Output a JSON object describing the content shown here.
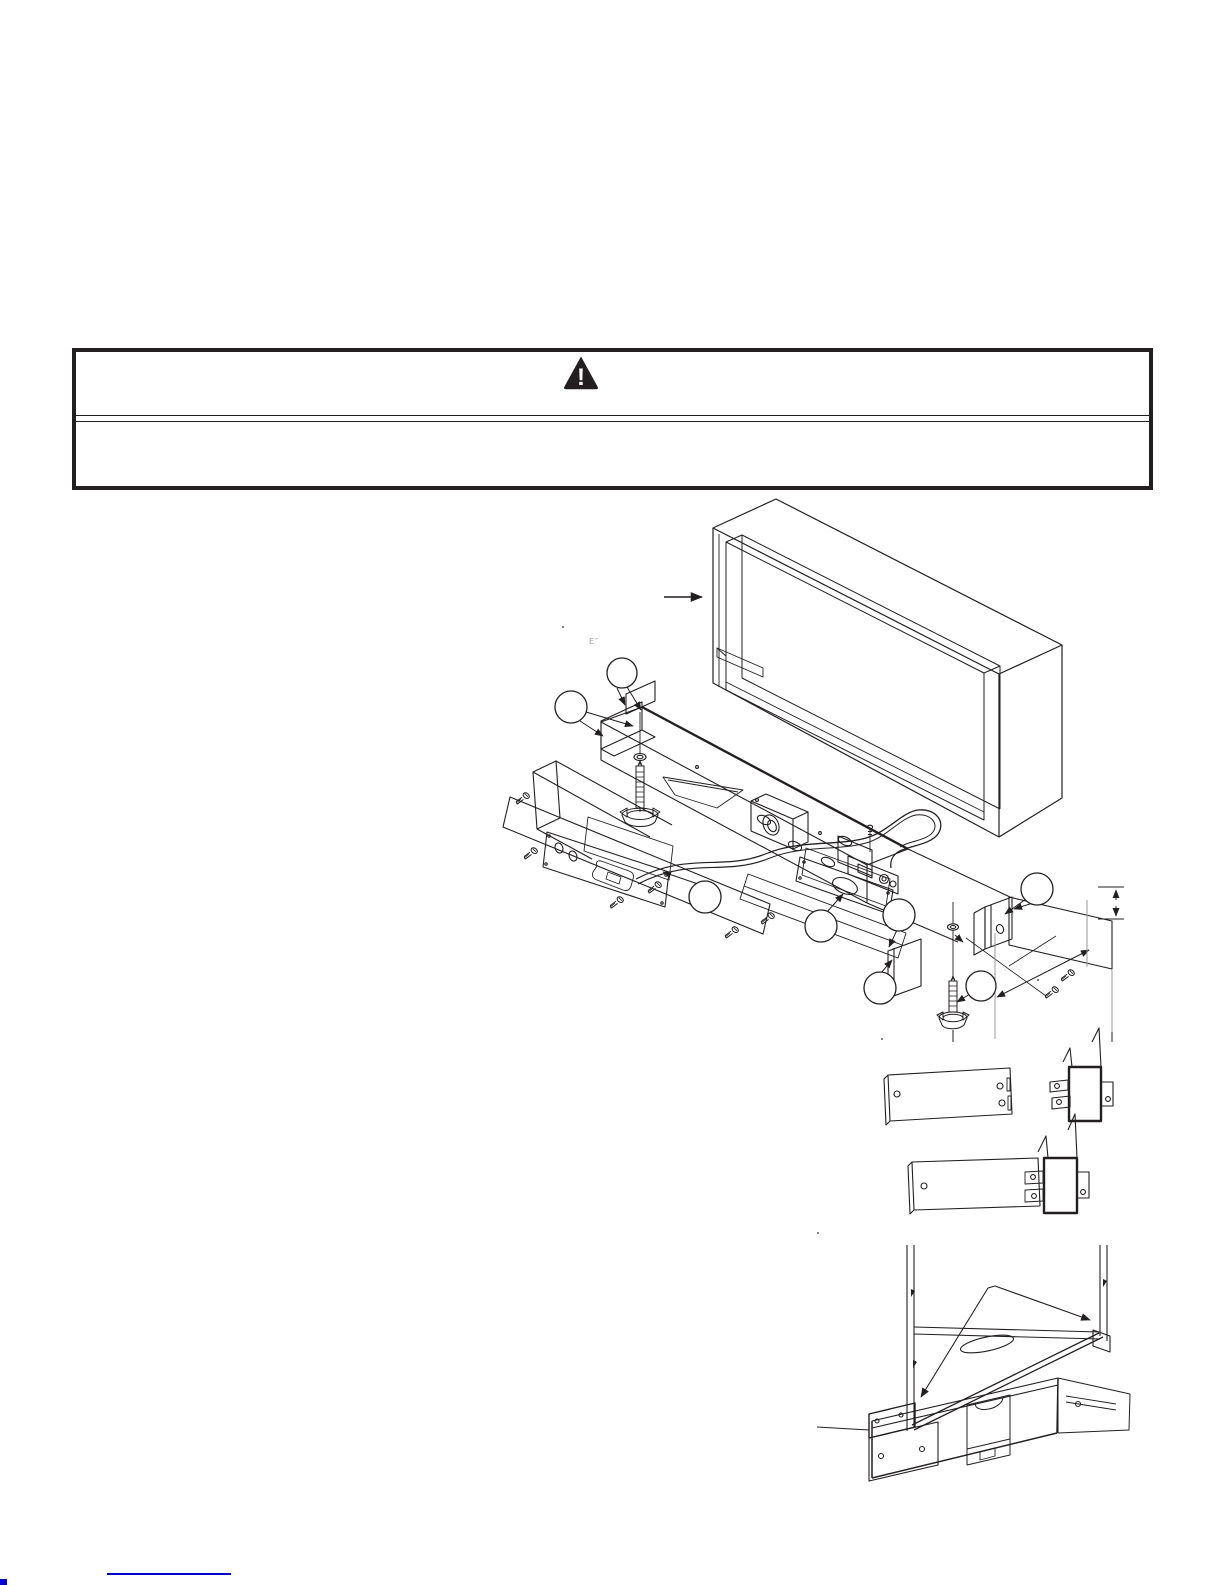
{
  "colors": {
    "ink": "#231f20",
    "light_gray": "#9a9a9a",
    "link_blue": "#0000cc",
    "paper": "#ffffff"
  },
  "warning": {
    "icon": "warning-triangle-icon",
    "exclamation": "!"
  },
  "artifacts": {
    "faint_glyph": "E″",
    "dots": [
      {
        "x": 563,
        "y": 627
      },
      {
        "x": 882,
        "y": 1039
      },
      {
        "x": 818,
        "y": 1233
      },
      {
        "x": 1038,
        "y": 980
      }
    ]
  },
  "figures": {
    "main_callouts": [
      {
        "x": 622,
        "y": 673,
        "r": 15
      },
      {
        "x": 571,
        "y": 707,
        "r": 16
      },
      {
        "x": 705,
        "y": 897,
        "r": 16
      },
      {
        "x": 821,
        "y": 926,
        "r": 16
      },
      {
        "x": 899,
        "y": 915,
        "r": 16
      },
      {
        "x": 1037,
        "y": 889,
        "r": 16
      },
      {
        "x": 880,
        "y": 988,
        "r": 16
      },
      {
        "x": 981,
        "y": 986,
        "r": 15
      }
    ],
    "screws": [
      {
        "x": 523,
        "y": 798
      },
      {
        "x": 531,
        "y": 853
      },
      {
        "x": 617,
        "y": 902
      },
      {
        "x": 655,
        "y": 887
      },
      {
        "x": 732,
        "y": 932
      },
      {
        "x": 768,
        "y": 918
      },
      {
        "x": 1052,
        "y": 992
      },
      {
        "x": 1068,
        "y": 975
      }
    ]
  }
}
